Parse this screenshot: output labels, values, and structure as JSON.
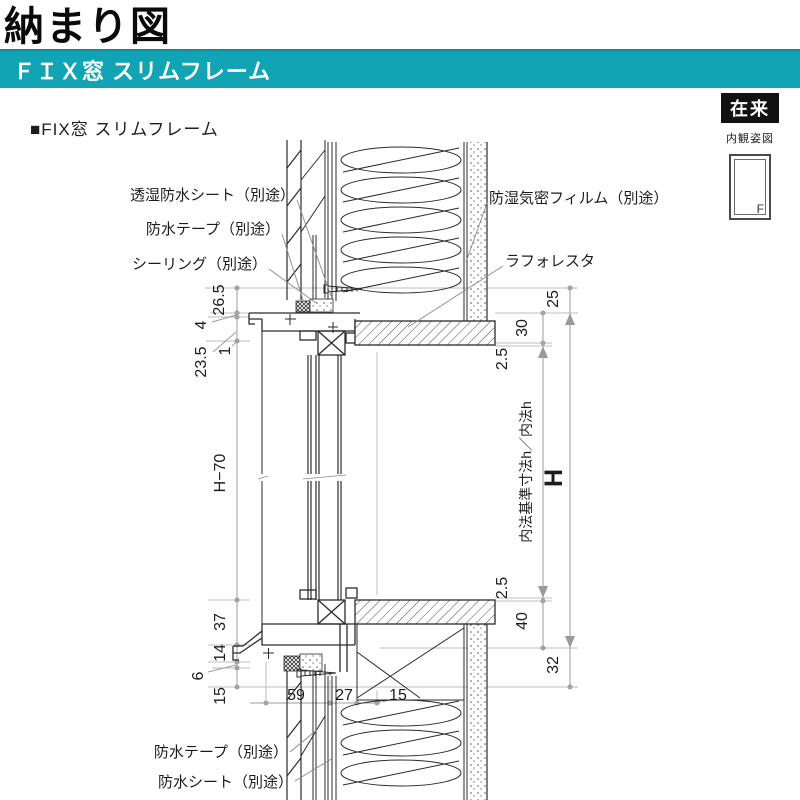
{
  "page": {
    "title": "納まり図"
  },
  "banner": {
    "label": "ＦＩＸ窓 スリムフレーム",
    "bg": "#10a4b4"
  },
  "section": {
    "label": "■FIX窓 スリムフレーム"
  },
  "legend": {
    "tag": "在来",
    "caption": "内観姿図",
    "window_mark": "F"
  },
  "labels": {
    "sheet_top": "透湿防水シート（別途）",
    "tape_top": "防水テープ（別途）",
    "sealing": "シーリング（別途）",
    "film": "防湿気密フィルム（別途）",
    "laforesta": "ラフォレスタ",
    "tape_bottom": "防水テープ（別途）",
    "sheet_bottom": "防水シート（別途）"
  },
  "dims": {
    "left": {
      "a": "26.5",
      "b": "4",
      "c": "1",
      "d": "23.5",
      "e": "H−70",
      "f": "37",
      "g": "14",
      "h": "6",
      "i": "15"
    },
    "bottom": {
      "a": "59",
      "b": "27",
      "c": "15"
    },
    "right": {
      "a": "25",
      "b": "30",
      "c": "2.5",
      "d": "内法基準寸法h／内法h",
      "e": "H",
      "f": "2.5",
      "g": "40",
      "h": "32"
    }
  },
  "colors": {
    "accent_teal": "#10a4b4",
    "tag_black": "#111111",
    "line_dark": "#2b2b2b",
    "line_dim": "#9c9c9c",
    "line_ext": "#bcbcbc"
  }
}
